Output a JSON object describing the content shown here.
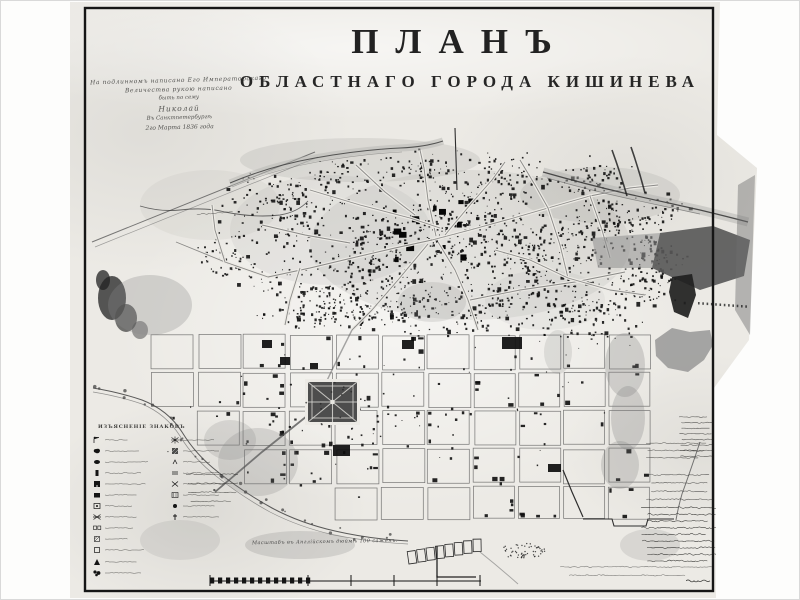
{
  "title": {
    "line1": "ПЛАНЪ",
    "line2": "ОБЛАСТНАГО ГОРОДА КИШИНЕВА"
  },
  "imperial_note": {
    "lines": [
      "На подлинномъ написано Его Императорскаго",
      "Величества рукою написано",
      "быть по сему",
      "Николай",
      "Въ Санктпетербургѣ",
      "2го Марта 1836 года"
    ]
  },
  "legend": {
    "header": "ИЗЪЯСНЕНІЕ ЗНАКОВЪ",
    "labels_illegible": true,
    "items_left": [
      {
        "symbol": "flag-mark"
      },
      {
        "symbol": "filled-blob"
      },
      {
        "symbol": "filled-oval"
      },
      {
        "symbol": "filled-rect-tall"
      },
      {
        "symbol": "notched-rect"
      },
      {
        "symbol": "filled-rect"
      },
      {
        "symbol": "open-rect-dot"
      },
      {
        "symbol": "crossed-lines"
      },
      {
        "symbol": "open-square-pair"
      },
      {
        "symbol": "hatched-square-small"
      },
      {
        "symbol": "open-square"
      },
      {
        "symbol": "dark-wedge"
      },
      {
        "symbol": "dark-cluster"
      }
    ],
    "items_right": [
      {
        "symbol": "starburst"
      },
      {
        "symbol": "hatched-square"
      },
      {
        "symbol": "tick-mark"
      },
      {
        "symbol": "parallel-dashes"
      },
      {
        "symbol": "cross-mark"
      },
      {
        "symbol": "stippled-square"
      },
      {
        "symbol": "small-blob"
      },
      {
        "symbol": "church-cross"
      }
    ]
  },
  "scale": {
    "caption": "Масштабъ въ Англійскомъ дюймѣ 100 саженъ."
  },
  "handwriting": {
    "blocks": {
      "right_edge_note": {
        "lines": 8,
        "amp": 1.3,
        "dark": 0.75
      },
      "bottom_right_note_0": {
        "lines": 3,
        "amp": 1.4,
        "dark": 0.7
      },
      "bottom_right_note_1": {
        "lines": 4,
        "amp": 1.5,
        "dark": 0.75
      },
      "bottom_right_note_2": {
        "lines": 9,
        "amp": 1.9,
        "dark": 0.9
      },
      "bottom_right_line": {
        "lines": 2,
        "amp": 1.5,
        "dark": 0.6
      },
      "legend_side_note": {
        "lines": 4,
        "amp": 1.3,
        "dark": 0.7
      },
      "road_label": {
        "lines": 1,
        "amp": 1.5,
        "dark": 0.6
      },
      "signature": {
        "lines": 1,
        "amp": 4.0,
        "dark": 0.85
      }
    }
  },
  "colors": {
    "paper": "#eceae5",
    "ink": "#141414",
    "street": "#4a4a4a",
    "wash": "#a8a8a5",
    "park": "#3c3c3c",
    "frame": "#161616"
  }
}
